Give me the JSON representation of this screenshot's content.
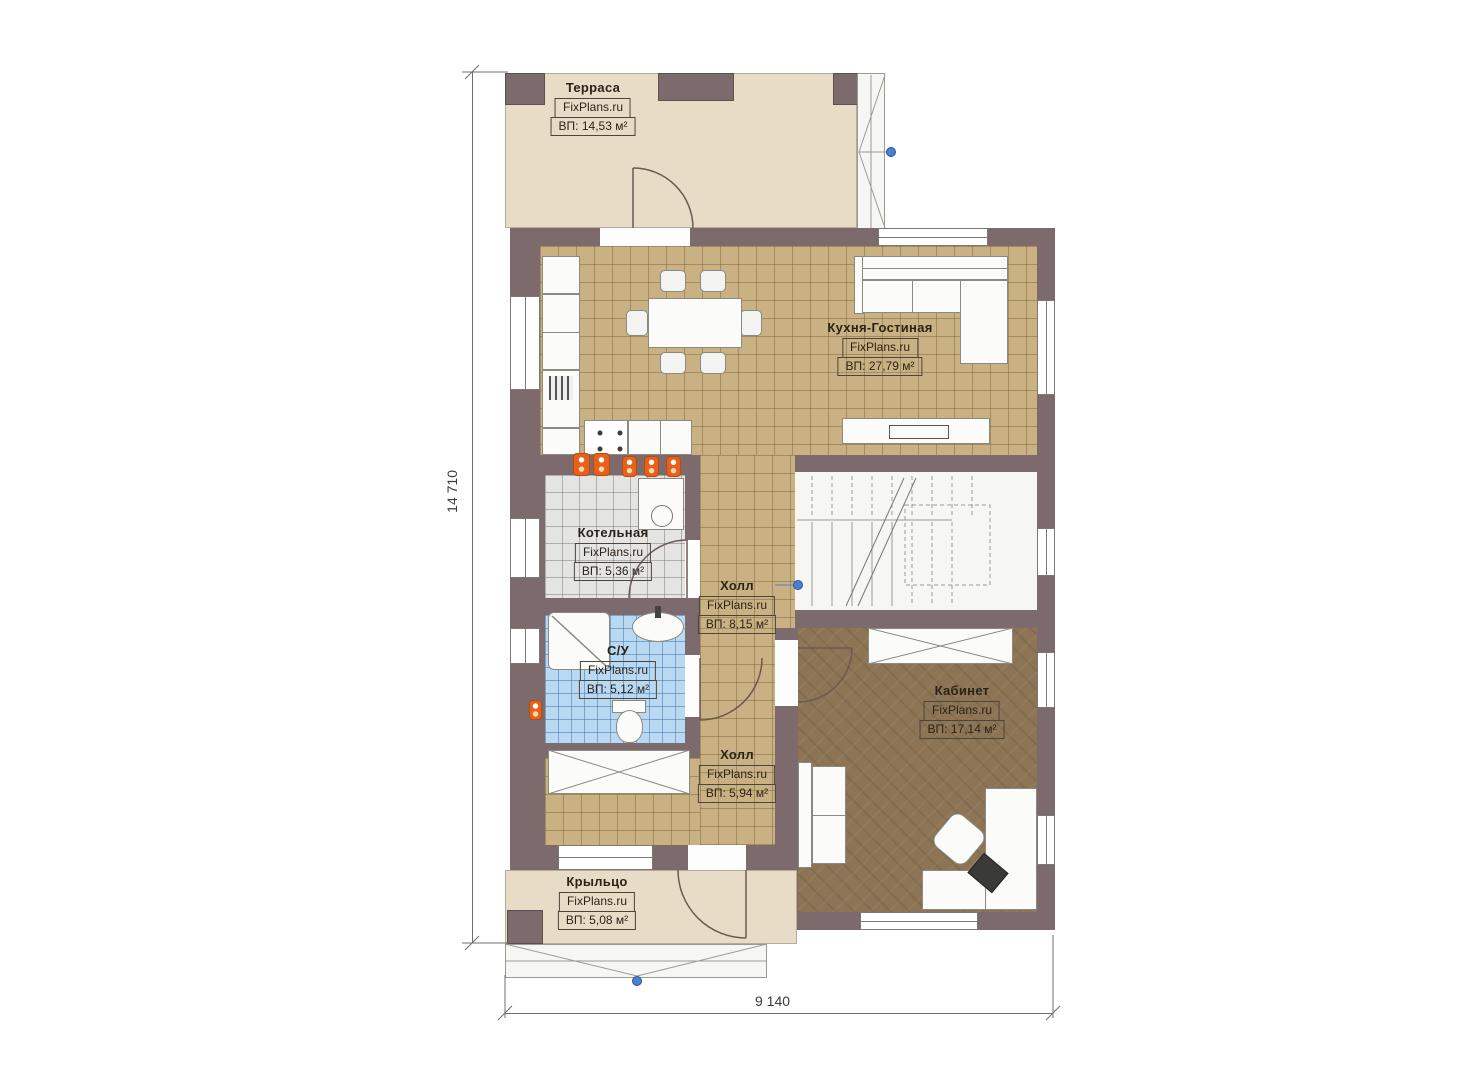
{
  "plan": {
    "dimensions": {
      "height_label": "14 710",
      "width_label": "9 140"
    },
    "rooms": [
      {
        "id": "terrace",
        "name": "Терраса",
        "brand": "FixPlans.ru",
        "area": "ВП: 14,53 м²"
      },
      {
        "id": "kitchen-living",
        "name": "Кухня-Гостиная",
        "brand": "FixPlans.ru",
        "area": "ВП: 27,79 м²"
      },
      {
        "id": "boiler-room",
        "name": "Котельная",
        "brand": "FixPlans.ru",
        "area": "ВП: 5,36 м²"
      },
      {
        "id": "hall-upper",
        "name": "Холл",
        "brand": "FixPlans.ru",
        "area": "ВП: 8,15 м²"
      },
      {
        "id": "bathroom",
        "name": "С/У",
        "brand": "FixPlans.ru",
        "area": "ВП: 5,12 м²"
      },
      {
        "id": "hall-lower",
        "name": "Холл",
        "brand": "FixPlans.ru",
        "area": "ВП: 5,94 м²"
      },
      {
        "id": "office",
        "name": "Кабинет",
        "brand": "FixPlans.ru",
        "area": "ВП: 17,14 м²"
      },
      {
        "id": "porch",
        "name": "Крыльцо",
        "brand": "FixPlans.ru",
        "area": "ВП: 5,08 м²"
      }
    ],
    "colors": {
      "wall": "#7c6a6c",
      "floor_tan": "#c9b183",
      "floor_gray": "#e4e4e2",
      "floor_blue": "#b9d8f1",
      "floor_wood": "#8c7454",
      "floor_beige": "#e9dcc6",
      "radiator_orange": "#e8611c",
      "marker_blue": "#4a7fd4"
    }
  }
}
